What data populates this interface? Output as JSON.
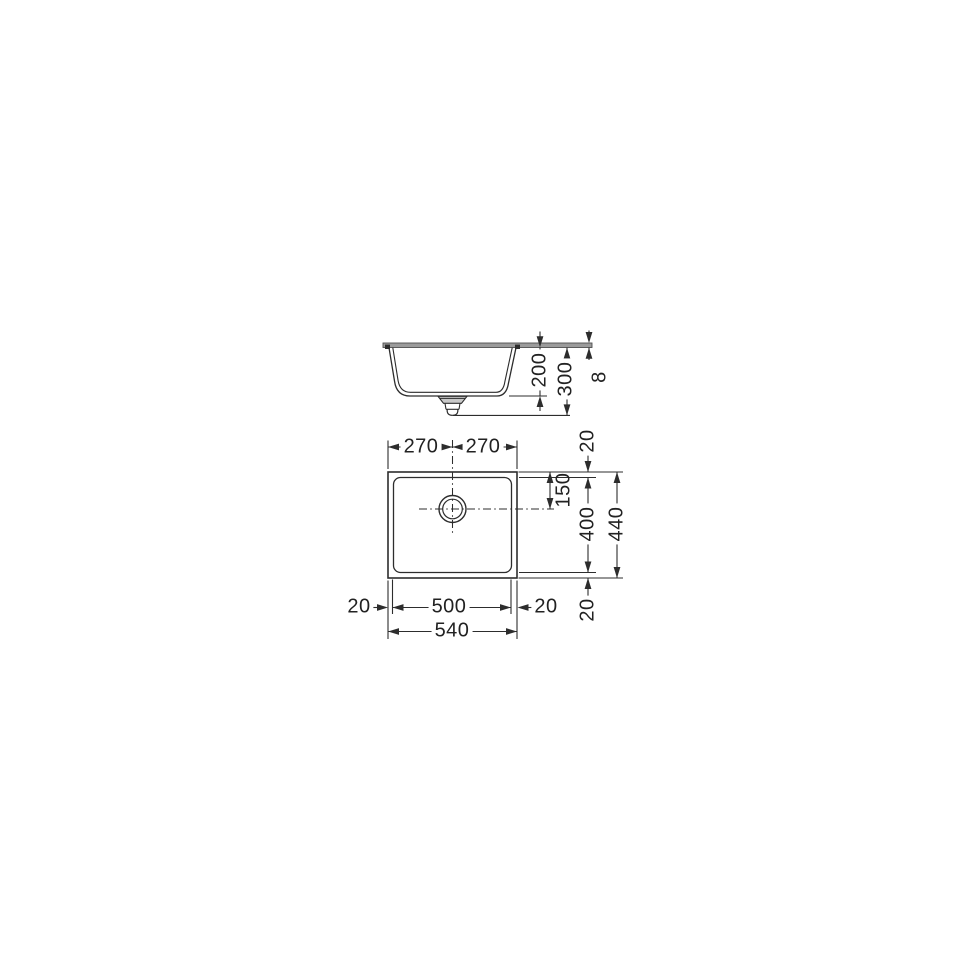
{
  "drawing": {
    "kind": "technical-dimension-drawing",
    "subject": "undermount rectangular sink with center drain, side section and plan view",
    "line_color": "#2d2d2d",
    "countertop_fill": "#9b9b9b",
    "side_view": {
      "labels": {
        "bowl_depth": "200",
        "overall_depth": "300",
        "counter_thickness": "8"
      }
    },
    "plan_view": {
      "labels": {
        "half_width_left": "270",
        "half_width_right": "270",
        "rim_top": "20",
        "drain_center_from_top": "150",
        "bowl_length": "400",
        "overall_length": "440",
        "rim_bottom": "20",
        "rim_left": "20",
        "bowl_width": "500",
        "rim_right": "20",
        "overall_width": "540"
      }
    }
  }
}
